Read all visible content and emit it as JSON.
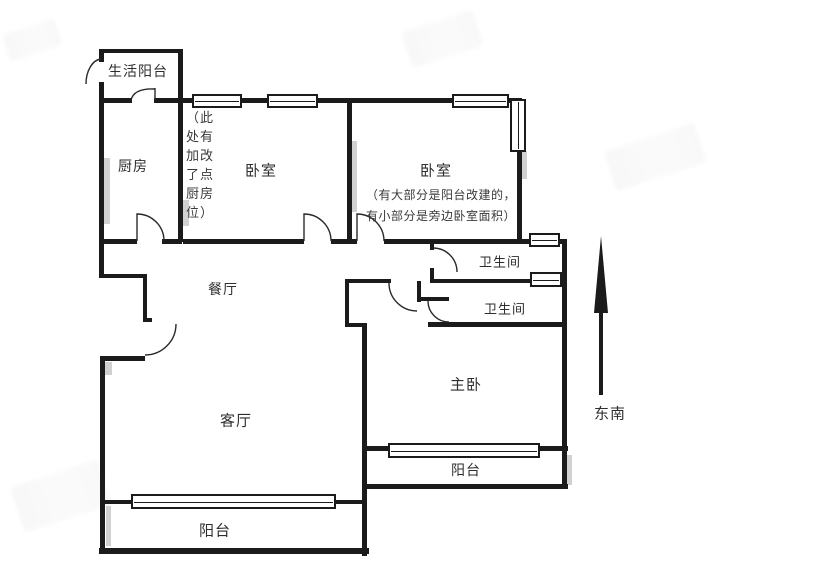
{
  "figure_type": "apartment-floor-plan",
  "colors": {
    "wall": "#1b1b1b",
    "shadow": "#c9c9c9",
    "text": "#2e2e2e",
    "background": "#ffffff"
  },
  "compass": {
    "label": "东南"
  },
  "rooms": {
    "life_balcony": {
      "label": "生活阳台"
    },
    "kitchen": {
      "label": "厨房"
    },
    "bedroom1": {
      "label": "卧室",
      "note": "（此处有加改了点厨房位）"
    },
    "bedroom2": {
      "label": "卧室",
      "note_line1": "（有大部分是阳台改建的，",
      "note_line2": "有小部分是旁边卧室面积）"
    },
    "dining": {
      "label": "餐厅"
    },
    "bathroom1": {
      "label": "卫生间"
    },
    "bathroom2": {
      "label": "卫生间"
    },
    "master": {
      "label": "主卧"
    },
    "living": {
      "label": "客厅"
    },
    "balcony_right": {
      "label": "阳台"
    },
    "balcony_bottom": {
      "label": "阳台"
    }
  }
}
